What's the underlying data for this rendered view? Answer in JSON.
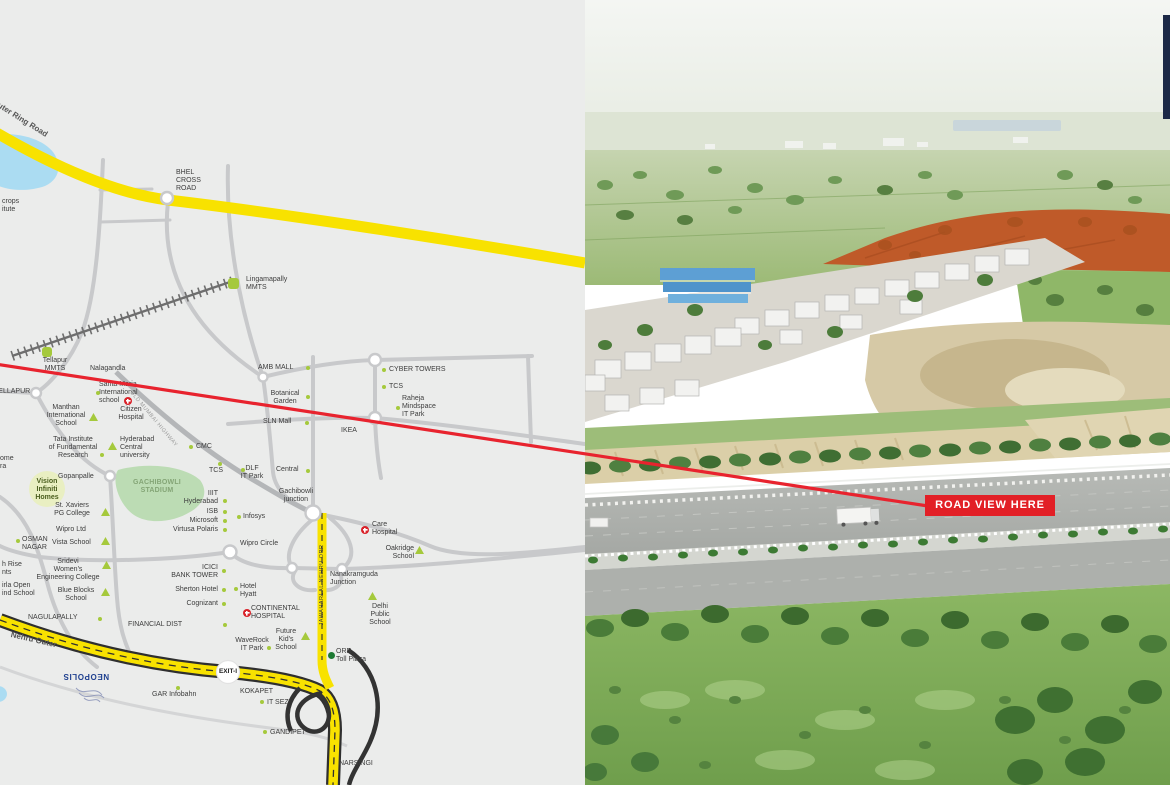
{
  "colors": {
    "map_bg": "#EBECEB",
    "road_gray": "#C8C9CB",
    "orr_yellow": "#F8E200",
    "accent_red": "#E8232E",
    "poi_green": "#A5C93C",
    "toll_green": "#1D7A33",
    "stadium_green": "#BCDCB4",
    "lake_blue": "#ABDCF2",
    "neopolis_blue": "#1E3F8F",
    "hospital_red": "#D9232A",
    "casing_black": "#2F2F2F",
    "photo_navy": "#1C2947"
  },
  "map": {
    "roads": {
      "orr_top": "Nehru Outer Ring Road",
      "orr_bottom": "Nehru Outer",
      "jnorr": "JAWAHARLAL NEHRU ORR",
      "old_mumbai": "OLD MUMBAI HIGHWAY"
    },
    "labels": {
      "bhel": "BHEL\nCROSS\nROAD",
      "lingampally": "Lingamapally\nMMTS",
      "tellapur_mmts": "Tellapur\nMMTS",
      "nalagandla": "Nalagandla",
      "tellapur": "TELLAPUR",
      "santa_maria": "Santa Maria\nInternational\nschool",
      "citizen": "Citizen\nHospital",
      "manthan": "Manthan\nInternational\nSchool",
      "tata": "Tata Institute\nof Fundamental\nResearch",
      "hcu": "Hyderabad\nCentral\nuniversity",
      "cmc": "CMC",
      "tcs_g": "TCS",
      "dlf": "DLF\nIT Park",
      "central": "Central",
      "gachibowli_jn": "Gachibowli\njunction",
      "iiit": "IIIT\nHyderabad",
      "isb": "ISB",
      "microsoft": "Microsoft",
      "virtusa": "Virtusa Polaris",
      "infosys": "Infosys",
      "amb": "AMB MALL",
      "cyber": "CYBER TOWERS",
      "tcs_c": "TCS",
      "raheja": "Raheja\nMindspace\nIT Park",
      "botanical": "Botanical\nGarden",
      "sln": "SLN Mall",
      "ikea": "IKEA",
      "stadium": "GACHIBOWLI\nSTADIUM",
      "vision": "Vision\nInfiniti\nHomes",
      "gopanpalle": "Gopanpalle",
      "xaviers": "St. Xaviers\nPG College",
      "wipro_ltd": "Wipro Ltd",
      "osman": "OSMAN\nNAGAR",
      "vista": "Vista School",
      "sridevi": "Sridevi\nWomen's\nEngineering College",
      "blue_blocks": "Blue Blocks\nSchool",
      "frag_home": "ome\nra",
      "frag_crops": "crops\nitute",
      "frag_highrise": "h Rise\nnts",
      "frag_birla": "irla Open\nind School",
      "nagulapally": "NAGULAPALLY",
      "financial": "FINANCIAL DIST",
      "icici": "ICICI\nBANK TOWER",
      "sherton": "Sherton Hotel",
      "hyatt": "Hotel\nHyatt",
      "cognizant": "Cognizant",
      "continental": "CONTINENTAL\nHOSPITAL",
      "waverock": "WaveRock\nIT Park",
      "future_kids": "Future\nKid's\nSchool",
      "dps": "Delhi\nPublic\nSchool",
      "nanakramguda": "Nanakramguda\nJunction",
      "oakridge": "Oakridge\nSchool",
      "care": "Care\nHospital",
      "wipro_circle": "Wipro Circle",
      "exit1": "EXIT-I",
      "neopolis": "NEOPOLIS",
      "gar": "GAR Infobahn",
      "kokapet": "KOKAPET",
      "kokapet2": "IT SEZ",
      "orr_toll": "ORR\nToll Plaza",
      "gandipet": "GANDIPET",
      "narsingi": "NARSINGI"
    }
  },
  "photo": {
    "road_view": "ROAD VIEW HERE"
  }
}
